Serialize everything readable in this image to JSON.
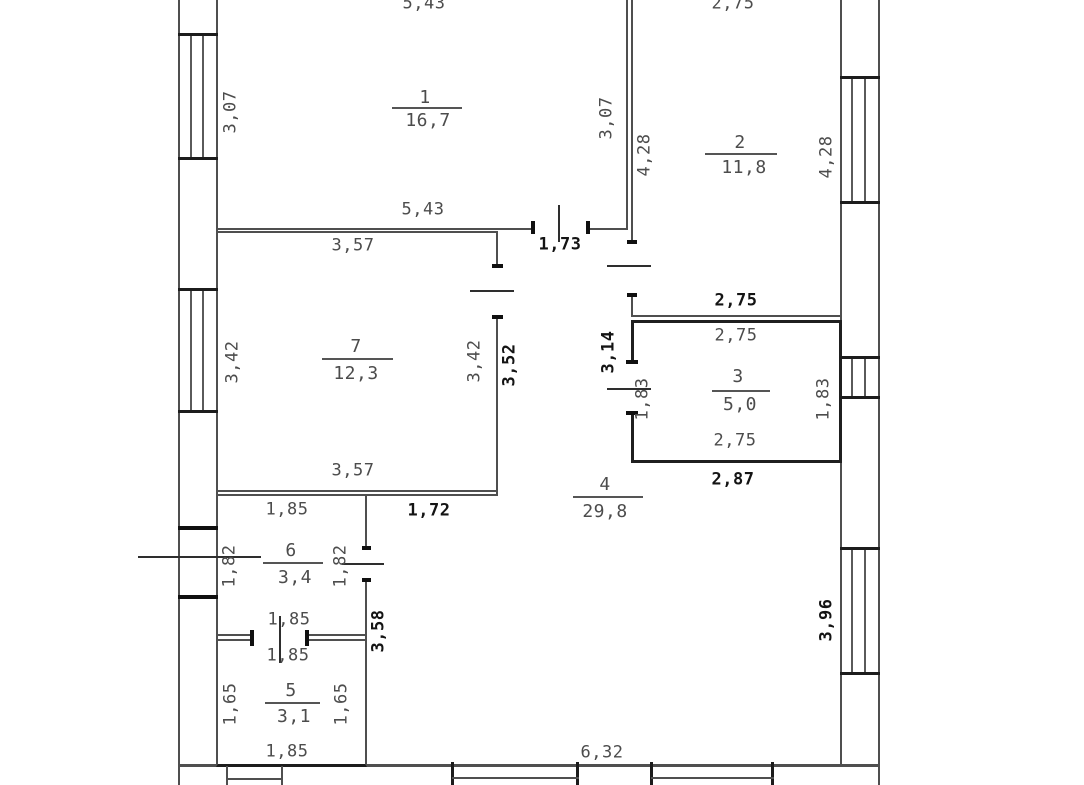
{
  "plan": {
    "type": "floor-plan",
    "rooms": [
      {
        "number": "1",
        "area": "16,7",
        "dim_top": "5,43",
        "dim_bottom": "5,43",
        "dim_left": "3,07",
        "dim_right": "3,07"
      },
      {
        "number": "2",
        "area": "11,8",
        "dim_top": "2,75",
        "dim_bottom": "2,75",
        "dim_left": "4,28",
        "dim_right": "4,28"
      },
      {
        "number": "3",
        "area": "5,0",
        "dim_top": "2,75",
        "dim_bottom": "2,75",
        "dim_left": "1,83",
        "dim_right": "1,83"
      },
      {
        "number": "4",
        "area": "29,8",
        "dim_door_top": "1,73",
        "dim_left_upper": "3,52",
        "dim_corridor": "3,14",
        "dim_left_mid": "1,72",
        "dim_below_room3": "2,87",
        "dim_left_lower": "3,58",
        "dim_right": "3,96",
        "dim_bottom": "6,32"
      },
      {
        "number": "5",
        "area": "3,1",
        "dim_top": "1,85",
        "dim_bottom": "1,85",
        "dim_left": "1,65",
        "dim_right": "1,65"
      },
      {
        "number": "6",
        "area": "3,4",
        "dim_top": "1,85",
        "dim_bottom": "1,85",
        "dim_left": "1,82",
        "dim_right": "1,82"
      },
      {
        "number": "7",
        "area": "12,3",
        "dim_top": "3,57",
        "dim_bottom": "3,57",
        "dim_left": "3,42",
        "dim_right": "3,42"
      }
    ],
    "colors": {
      "wall": "#4f4f4f",
      "wall_bold": "#1c1c1c",
      "text": "#4c4c4c",
      "text_bold": "#141414",
      "background": "#ffffff"
    }
  }
}
